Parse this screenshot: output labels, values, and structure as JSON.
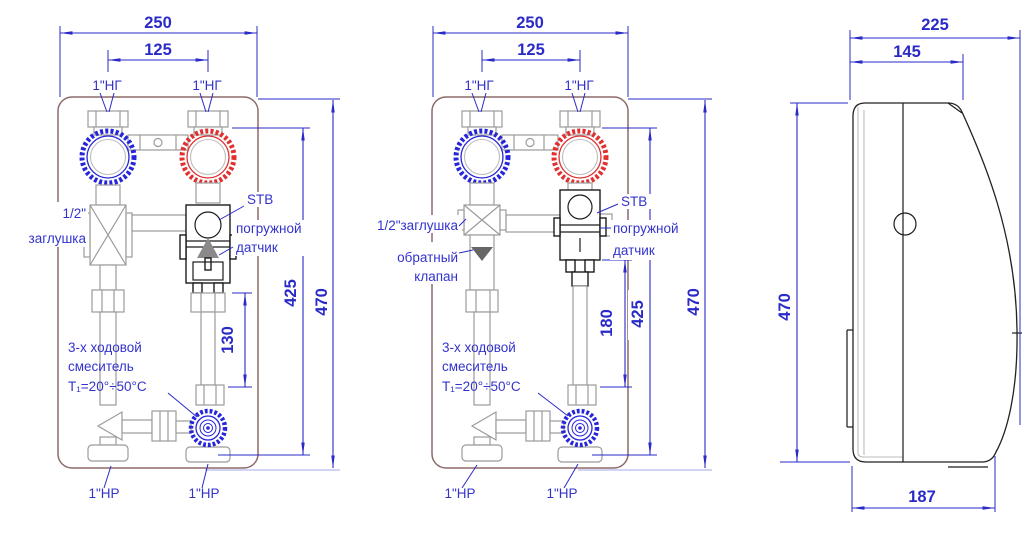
{
  "views": {
    "front_open": {
      "dims": {
        "width": "250",
        "spacing": "125",
        "height": "470",
        "inner": "425",
        "gap": "130"
      },
      "ports": {
        "top_left": "1\"НГ",
        "top_right": "1\"НГ",
        "bottom_left": "1\"НР",
        "bottom_right": "1\"НР"
      },
      "labels": {
        "plug1": "1/2\"",
        "plug2": "заглушка",
        "stb": "STB",
        "sensor1": "погружной",
        "sensor2": "датчик",
        "mixer1": "3-х ходовой",
        "mixer2": "смеситель",
        "mixer3": "T₁=20°÷50°C"
      }
    },
    "front_check": {
      "dims": {
        "width": "250",
        "spacing": "125",
        "height": "470",
        "inner": "425",
        "gap": "180"
      },
      "ports": {
        "top_left": "1\"НГ",
        "top_right": "1\"НГ",
        "bottom_left": "1\"НР",
        "bottom_right": "1\"НР"
      },
      "labels": {
        "plug": "1/2\"заглушка",
        "check1": "обратный",
        "check2": "клапан",
        "stb": "STB",
        "sensor1": "погружной",
        "sensor2": "датчик",
        "mixer1": "3-х ходовой",
        "mixer2": "смеситель",
        "mixer3": "T₁=20°÷50°C"
      }
    },
    "side": {
      "dims": {
        "depth": "225",
        "body": "145",
        "height": "470",
        "base": "187"
      }
    }
  },
  "colors": {
    "dimension": "#2a2ac8",
    "supply_blue": "#2626d8",
    "return_red": "#e03030",
    "pipe_gray": "#9b9b9b",
    "device_black": "#1c1c1c",
    "plate_brown": "#8d6a6a"
  }
}
